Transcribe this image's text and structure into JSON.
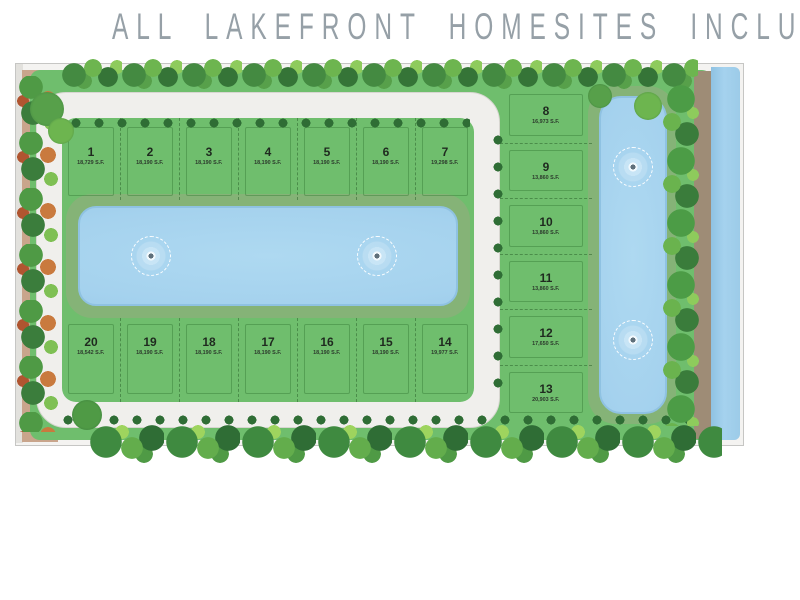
{
  "title": "ALL LAKEFRONT HOMESITES INCLUDED",
  "site_plan": {
    "top_row_lots": [
      {
        "number": "1",
        "area": "18,729 S.F."
      },
      {
        "number": "2",
        "area": "18,190 S.F."
      },
      {
        "number": "3",
        "area": "18,190 S.F."
      },
      {
        "number": "4",
        "area": "18,190 S.F."
      },
      {
        "number": "5",
        "area": "18,190 S.F."
      },
      {
        "number": "6",
        "area": "18,190 S.F."
      },
      {
        "number": "7",
        "area": "19,298 S.F."
      }
    ],
    "right_column_lots": [
      {
        "number": "8",
        "area": "16,973 S.F."
      },
      {
        "number": "9",
        "area": "13,860 S.F."
      },
      {
        "number": "10",
        "area": "13,860 S.F."
      },
      {
        "number": "11",
        "area": "13,860 S.F."
      },
      {
        "number": "12",
        "area": "17,650 S.F."
      },
      {
        "number": "13",
        "area": "20,903 S.F."
      }
    ],
    "bottom_row_lots": [
      {
        "number": "20",
        "area": "18,542 S.F."
      },
      {
        "number": "19",
        "area": "18,190 S.F."
      },
      {
        "number": "18",
        "area": "18,190 S.F."
      },
      {
        "number": "17",
        "area": "18,190 S.F."
      },
      {
        "number": "16",
        "area": "18,190 S.F."
      },
      {
        "number": "15",
        "area": "18,190 S.F."
      },
      {
        "number": "14",
        "area": "19,977 S.F."
      }
    ],
    "features": {
      "main_lake_fountains": 2,
      "east_lake_fountains": 2
    }
  },
  "colors": {
    "turf_green": "#6fbe6d",
    "lake_bank_green": "#85b377",
    "water_blue": "#a5d2ee",
    "road_gray": "#f0efec",
    "tan_buffer": "#c9a58c",
    "title_gray": "#96a0a7"
  }
}
